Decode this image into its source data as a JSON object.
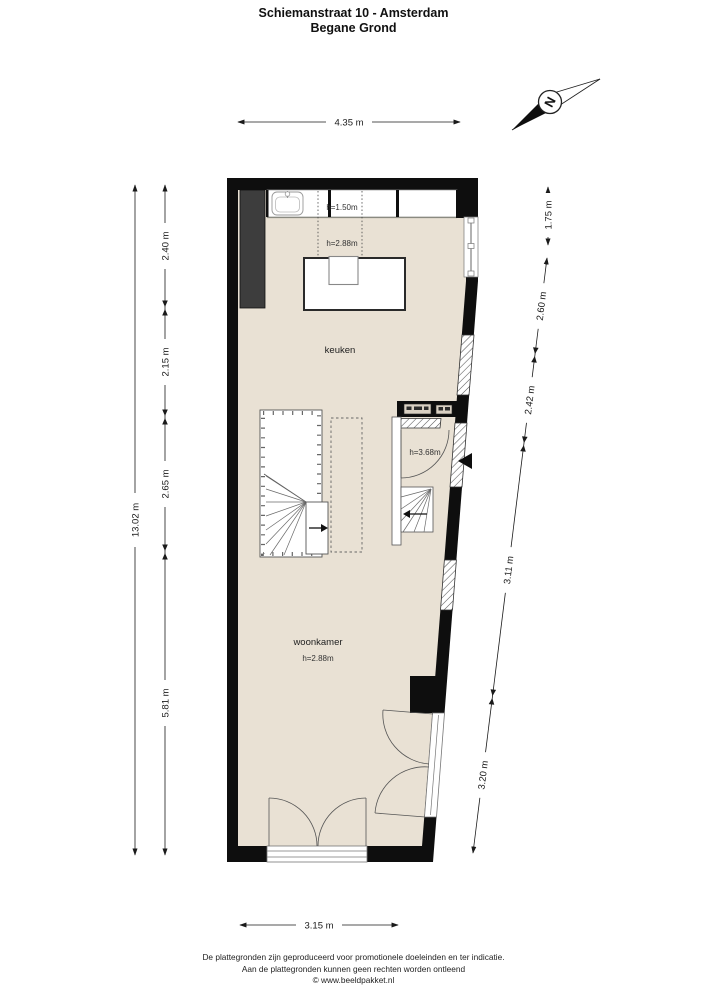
{
  "title": {
    "line1": "Schiemanstraat 10 - Amsterdam",
    "line2": "Begane Grond"
  },
  "compass": {
    "letter": "N"
  },
  "rooms": {
    "kitchen": "keuken",
    "living": "woonkamer"
  },
  "heights": {
    "counter": "h=1.50m",
    "kitchen": "h=2.88m",
    "entry": "h=3.68m",
    "living": "h=2.88m"
  },
  "dimensions": {
    "top": "4.35 m",
    "bottom": "3.15 m",
    "left_total": "13.02 m",
    "left_segments": [
      "2.40 m",
      "2.15 m",
      "2.65 m",
      "5.81 m"
    ],
    "right_top": "1.75 m",
    "right_segments": [
      "2.60 m",
      "2.42 m",
      "3.11 m",
      "3.20 m"
    ]
  },
  "footer": {
    "line1": "De plattegronden zijn geproduceerd voor promotionele doeleinden en ter indicatie.",
    "line2": "Aan de plattegronden kunnen geen rechten worden ontleend",
    "line3": "© www.beeldpakket.nl"
  },
  "colors": {
    "floor": "#e9e1d4",
    "wall": "#0e0e0e",
    "closet": "#3d3d3d",
    "line": "#1a1a1a"
  }
}
